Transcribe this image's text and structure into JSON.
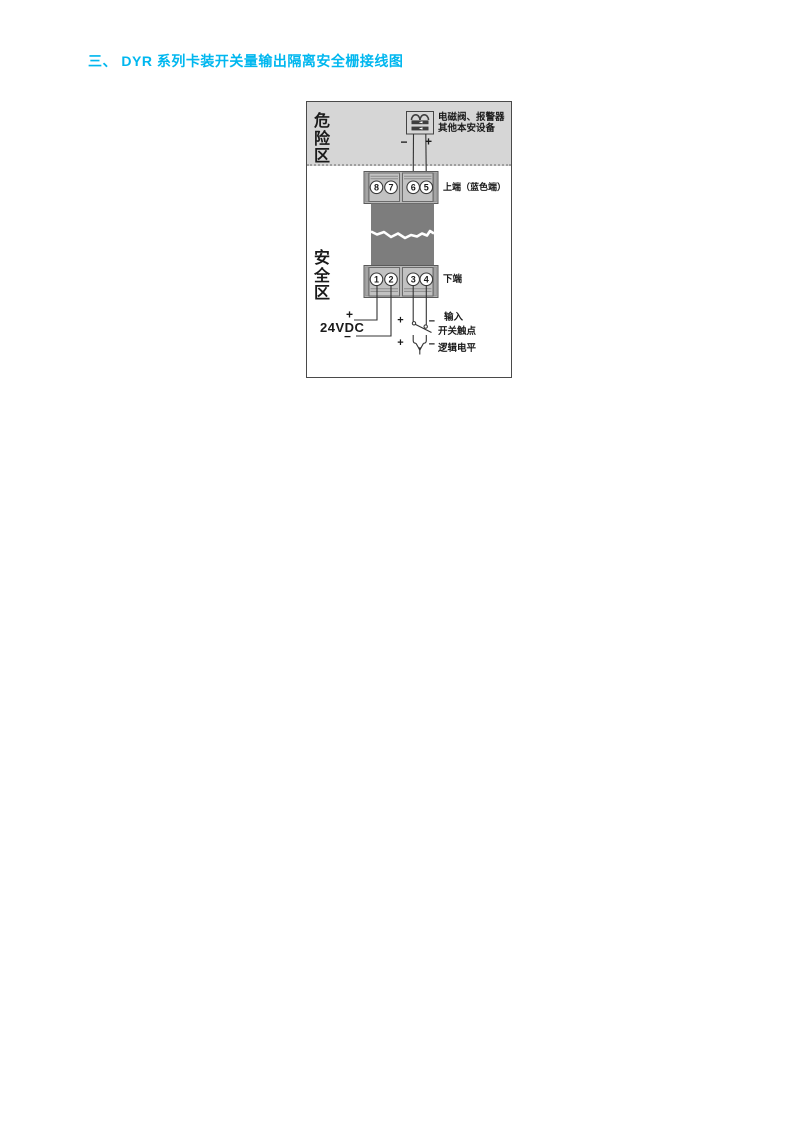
{
  "title": {
    "text": "三、 DYR 系列卡装开关量输出隔离安全栅接线图",
    "color": "#00b7ef"
  },
  "diagram": {
    "hazard_zone_label": "危险区",
    "safe_zone_label": "安全区",
    "device": {
      "label_line1": "电磁阀、报警器",
      "label_line2": "其他本安设备",
      "minus": "−",
      "plus": "+"
    },
    "top_terminal": {
      "numbers": [
        "8",
        "7",
        "6",
        "5"
      ],
      "label": "上端（蓝色端）"
    },
    "bottom_terminal": {
      "numbers": [
        "1",
        "2",
        "3",
        "4"
      ],
      "label": "下端"
    },
    "power_supply": {
      "label": "24VDC",
      "plus": "+",
      "minus": "−"
    },
    "switch_input": {
      "plus": "+",
      "minus": "−",
      "label_line1": "输入",
      "label_line2": "开关触点"
    },
    "logic_input": {
      "plus": "+",
      "minus": "−",
      "label": "逻辑电平"
    },
    "colors": {
      "hazard_bg": "#d6d6d6",
      "terminal_block": "#b8b8b8",
      "terminal_sub_block": "#c2c2c2",
      "module_body": "#7d7d7d",
      "title_accent": "#00b7ef"
    }
  }
}
